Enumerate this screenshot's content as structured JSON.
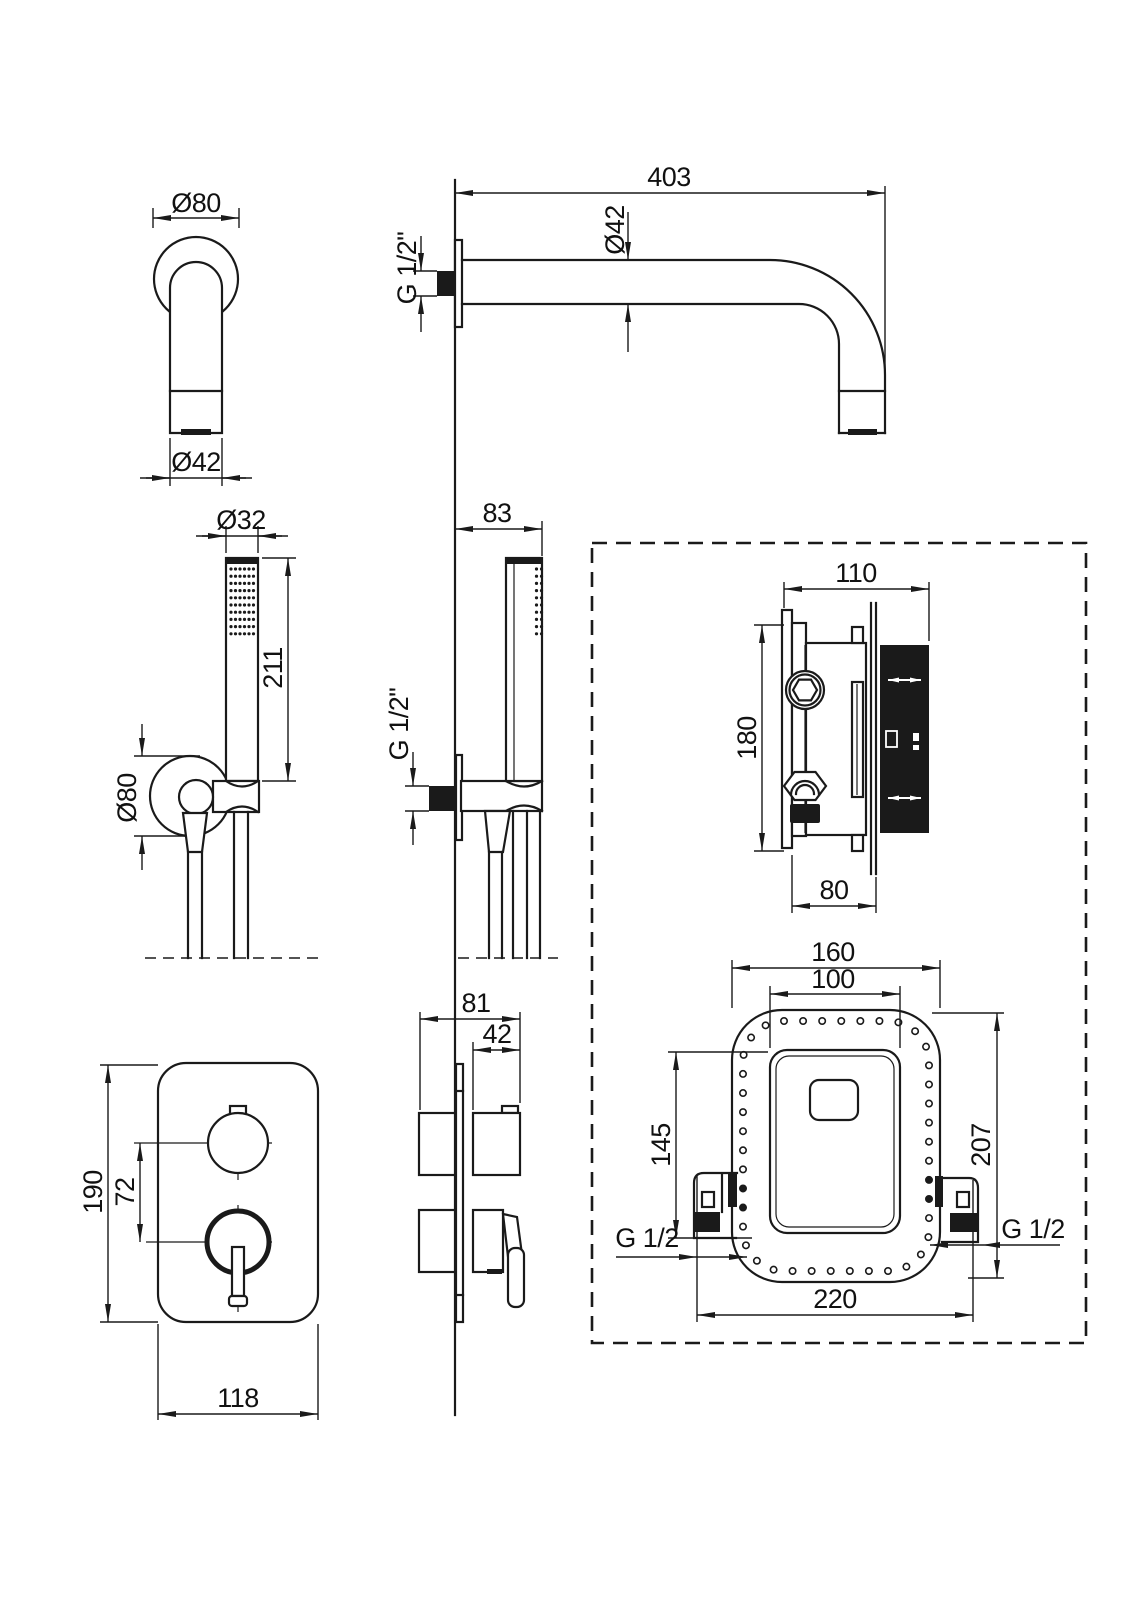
{
  "drawing": {
    "type": "technical-dimension-drawing",
    "subject": "concealed shower set: wall spout, hand shower, concealed mixer valve and trim plate",
    "colors": {
      "background": "#ffffff",
      "ink": "#1a1a1a"
    },
    "views": {
      "spout_front": {
        "flange_dia": "Ø80",
        "outlet_dia": "Ø42"
      },
      "spout_side": {
        "length": "403",
        "pipe_dia": "Ø42",
        "thread": "G 1/2\""
      },
      "handshower_front": {
        "wand_dia": "Ø32",
        "wand_length": "211",
        "holder_dia": "Ø80"
      },
      "handshower_side": {
        "offset": "83",
        "thread": "G 1/2\""
      },
      "valve_side": {
        "depth": "110",
        "height": "180",
        "body_depth": "80"
      },
      "valve_front": {
        "outer_width": "160",
        "inner_width": "100",
        "height_left": "145",
        "height_right": "207",
        "total_width": "220",
        "thread_left": "G 1/2",
        "thread_right": "G 1/2"
      },
      "trim_front": {
        "height": "190",
        "knob_spacing": "72",
        "width": "118"
      },
      "trim_side": {
        "total_depth": "81",
        "knob_depth": "42"
      }
    }
  }
}
